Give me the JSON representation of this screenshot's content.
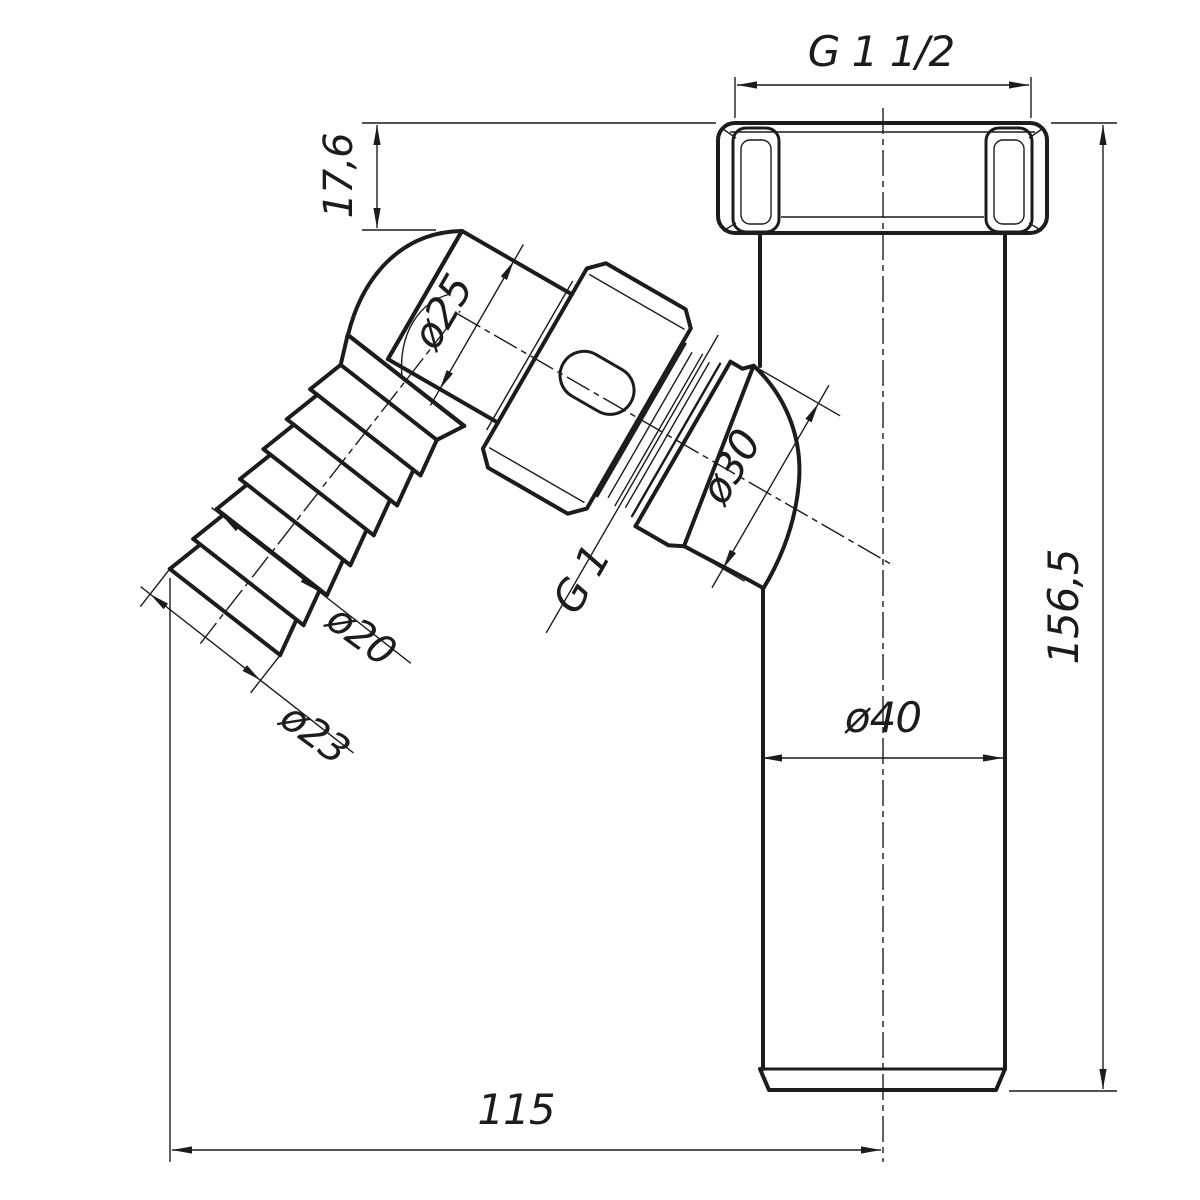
{
  "drawing": {
    "title": "pipe-trap-fitting-technical-drawing",
    "labels": {
      "top_thread": "G 1 1/2",
      "nut_height": "17,6",
      "elbow_pipe_dia": "ø25",
      "branch_dia": "ø30",
      "branch_thread": "G 1",
      "hose_valley_dia": "ø20",
      "hose_crest_dia": "ø23",
      "pipe_dia": "ø40",
      "total_height": "156,5",
      "offset_width": "115"
    },
    "colors": {
      "line": "#1c1c1c",
      "background": "#ffffff"
    }
  }
}
